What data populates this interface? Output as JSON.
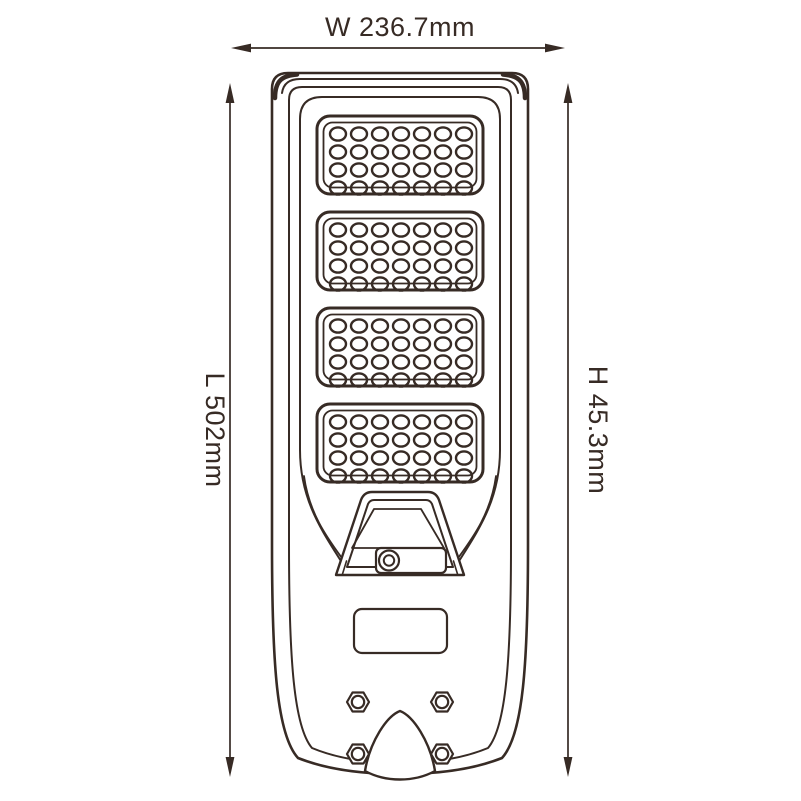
{
  "page": {
    "background": "#ffffff",
    "line_color": "#372b25"
  },
  "drawing": {
    "type": "technical-dimension-drawing",
    "subject": "all-in-one solar LED street light, front view",
    "dimensions": {
      "width_label": "W 236.7mm",
      "length_label": "L 502mm",
      "height_label": "H 45.3mm"
    },
    "led_panels": {
      "count": 4,
      "columns": 7,
      "rows": 4
    },
    "features": {
      "sensor": "motion-sensor-pod with lens",
      "label_plate": "blank nameplate",
      "mounting_bolts": 4,
      "pole_mount": "bottom center cover"
    }
  }
}
